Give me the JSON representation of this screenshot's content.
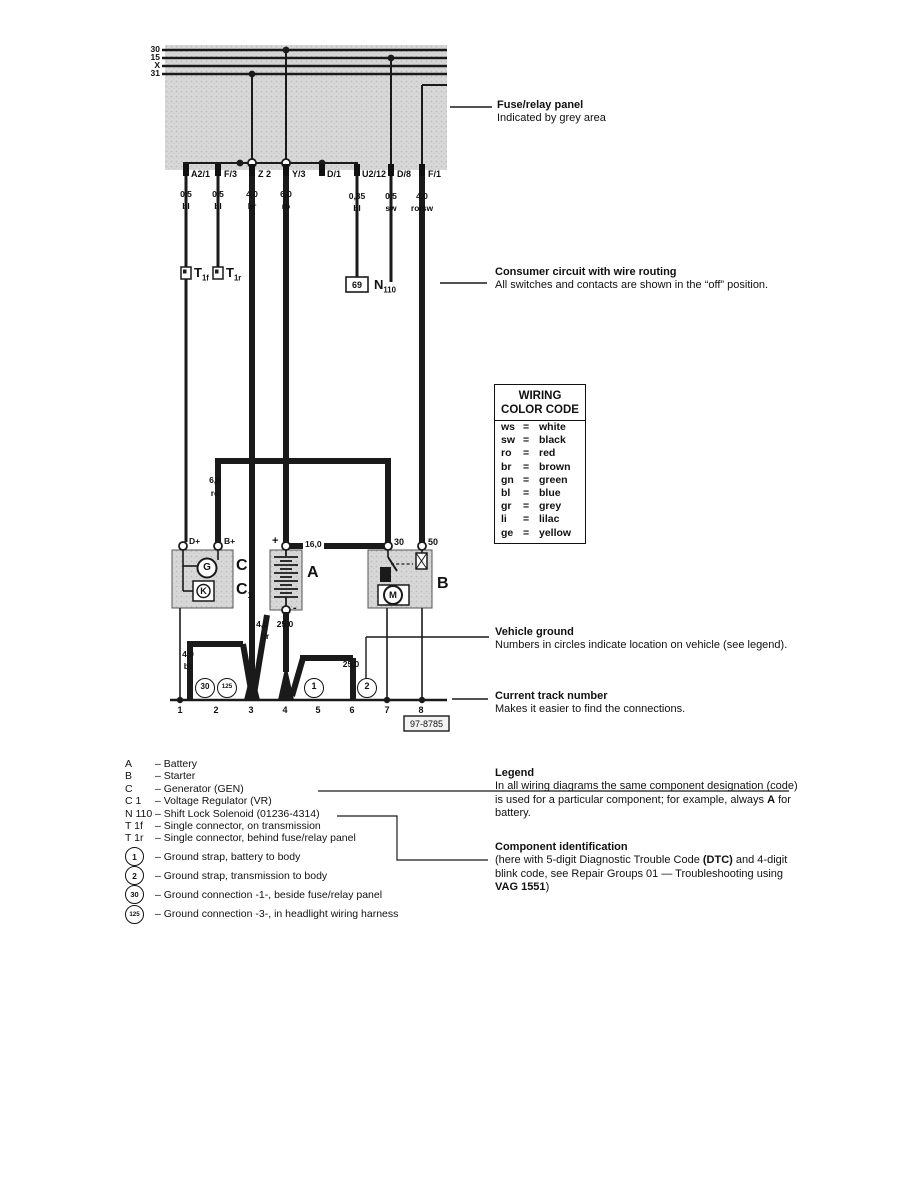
{
  "bus": {
    "labels": [
      "30",
      "15",
      "X",
      "31"
    ]
  },
  "terminals": [
    {
      "label": "A2/1",
      "gauge": "0,5",
      "color": "bl"
    },
    {
      "label": "F/3",
      "gauge": "0,5",
      "color": "bl"
    },
    {
      "label": "Z 2",
      "gauge": "4,0",
      "color": "br"
    },
    {
      "label": "Y/3",
      "gauge": "6,0",
      "color": "ro"
    },
    {
      "label": "D/1",
      "gauge": "",
      "color": ""
    },
    {
      "label": "U2/12",
      "gauge": "0,35",
      "color": "bl"
    },
    {
      "label": "D/8",
      "gauge": "0,5",
      "color": "sw"
    },
    {
      "label": "F/1",
      "gauge": "4,0",
      "color": "ro/sw"
    }
  ],
  "connectors": {
    "t1f": {
      "main": "T",
      "sub": "1f"
    },
    "t1r": {
      "main": "T",
      "sub": "1r"
    },
    "n110": {
      "main": "N",
      "sub": "110"
    },
    "box69": "69"
  },
  "wire_labels": {
    "w60_g": "6,0",
    "w60_c": "ro",
    "w160": "16,0",
    "w40L_g": "4,0",
    "w40L_c": "br",
    "w40B_g": "4,0",
    "w40B_c": "br",
    "w250_bat": "25,0",
    "w250_strap": "25,0"
  },
  "component_labels": {
    "c": "C",
    "c1_main": "C",
    "c1_sub": "1",
    "a": "A",
    "b": "B",
    "g": "G",
    "k": "K",
    "m": "M",
    "dplus": "D+",
    "bplus": "B+",
    "plus": "+",
    "minus": "-",
    "t30": "30",
    "t50": "50"
  },
  "ground_circles": {
    "g30": "30",
    "g125": "125",
    "g1": "1",
    "g2": "2"
  },
  "tracks": [
    "1",
    "2",
    "3",
    "4",
    "5",
    "6",
    "7",
    "8"
  ],
  "diagram_number": "97-8785",
  "color_code": {
    "title1": "WIRING",
    "title2": "COLOR CODE",
    "eq": "=",
    "entries": [
      [
        "ws",
        "white"
      ],
      [
        "sw",
        "black"
      ],
      [
        "ro",
        "red"
      ],
      [
        "br",
        "brown"
      ],
      [
        "gn",
        "green"
      ],
      [
        "bl",
        "blue"
      ],
      [
        "gr",
        "grey"
      ],
      [
        "li",
        "lilac"
      ],
      [
        "ge",
        "yellow"
      ]
    ]
  },
  "annotations": {
    "fuse": {
      "title": "Fuse/relay panel",
      "body": "Indicated by grey area"
    },
    "consumer": {
      "title": "Consumer circuit with wire routing",
      "body": "All switches and contacts are shown in the “off” position."
    },
    "vground": {
      "title": "Vehicle ground",
      "body": "Numbers in circles indicate location on vehicle (see legend)."
    },
    "track": {
      "title": "Current track number",
      "body": "Makes it easier to find the connections."
    },
    "legend": {
      "title": "Legend",
      "line1": "In all wiring diagrams the same component designation (code)",
      "line2_pre": "is used for a particular component; for example, always ",
      "line2_bold": "A",
      "line2_post": " for",
      "line3": "battery."
    },
    "component_id": {
      "title": "Component identification",
      "line1_pre": "(here with 5-digit Diagnostic Trouble Code ",
      "line1_bold": "(DTC)",
      "line1_post": " and 4-digit",
      "line2": "blink code, see Repair Groups 01 — Troubleshooting using",
      "line3_bold": "VAG 1551",
      "line3_post": ")"
    }
  },
  "legend_list": [
    {
      "code": "A",
      "desc": "– Battery"
    },
    {
      "code": "B",
      "desc": "– Starter"
    },
    {
      "code": "C",
      "desc": "– Generator (GEN)"
    },
    {
      "code": "C 1",
      "desc": "– Voltage Regulator (VR)"
    },
    {
      "code": "N 110",
      "desc": "– Shift Lock Solenoid (01236-4314)"
    },
    {
      "code": "T 1f",
      "desc": "– Single connector, on transmission"
    },
    {
      "code": "T 1r",
      "desc": "– Single connector, behind fuse/relay panel"
    }
  ],
  "ground_list": [
    {
      "num": "1",
      "desc": "– Ground strap, battery to body"
    },
    {
      "num": "2",
      "desc": "– Ground strap, transmission to body"
    },
    {
      "num": "30",
      "desc": "– Ground connection -1-, beside fuse/relay panel"
    },
    {
      "num": "125",
      "desc": "– Ground connection -3-, in headlight wiring harness"
    }
  ]
}
